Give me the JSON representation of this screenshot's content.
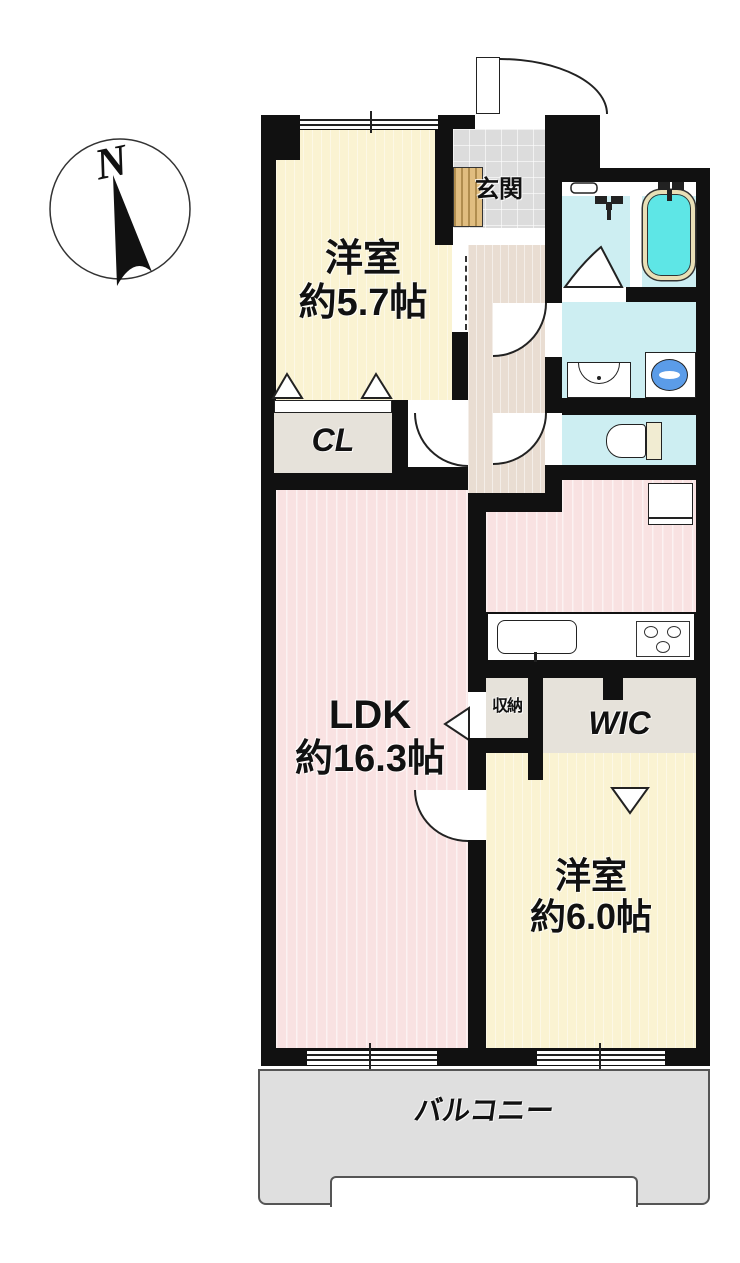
{
  "plan_title": "2LDK apartment floor plan",
  "compass": {
    "label": "N"
  },
  "rooms": {
    "western_room_1": {
      "name": "洋室",
      "size": "約5.7帖"
    },
    "ldk": {
      "name": "LDK",
      "size": "約16.3帖"
    },
    "western_room_2": {
      "name": "洋室",
      "size": "約6.0帖"
    },
    "closet": {
      "label": "CL"
    },
    "wic": {
      "label": "WIC"
    },
    "storage": {
      "label": "収納"
    },
    "entrance": {
      "label": "玄関"
    },
    "balcony": {
      "label": "バルコニー"
    }
  },
  "fixtures": [
    "bathtub",
    "shower-mixer",
    "washbasin",
    "washing-machine-pan",
    "toilet",
    "kitchen-sink",
    "stove",
    "refrigerator-space",
    "shoe-cabinet"
  ],
  "colors": {
    "wall": "#111111",
    "room_cream": "#faf3d2",
    "ldk_pink": "#f9e2e2",
    "hallway_beige": "#e9ddd2",
    "wet_area_cyan": "#cdeef2",
    "tub_water": "#5ee6e6",
    "tub_rim": "#e9dfb6",
    "closet_gray": "#e6e2da",
    "entrance_tile": "#dcdcdc",
    "balcony_gray": "#dfdfdf",
    "shoe_cabinet_tan": "#e0bd80",
    "washer_blue": "#5b9ce8"
  }
}
